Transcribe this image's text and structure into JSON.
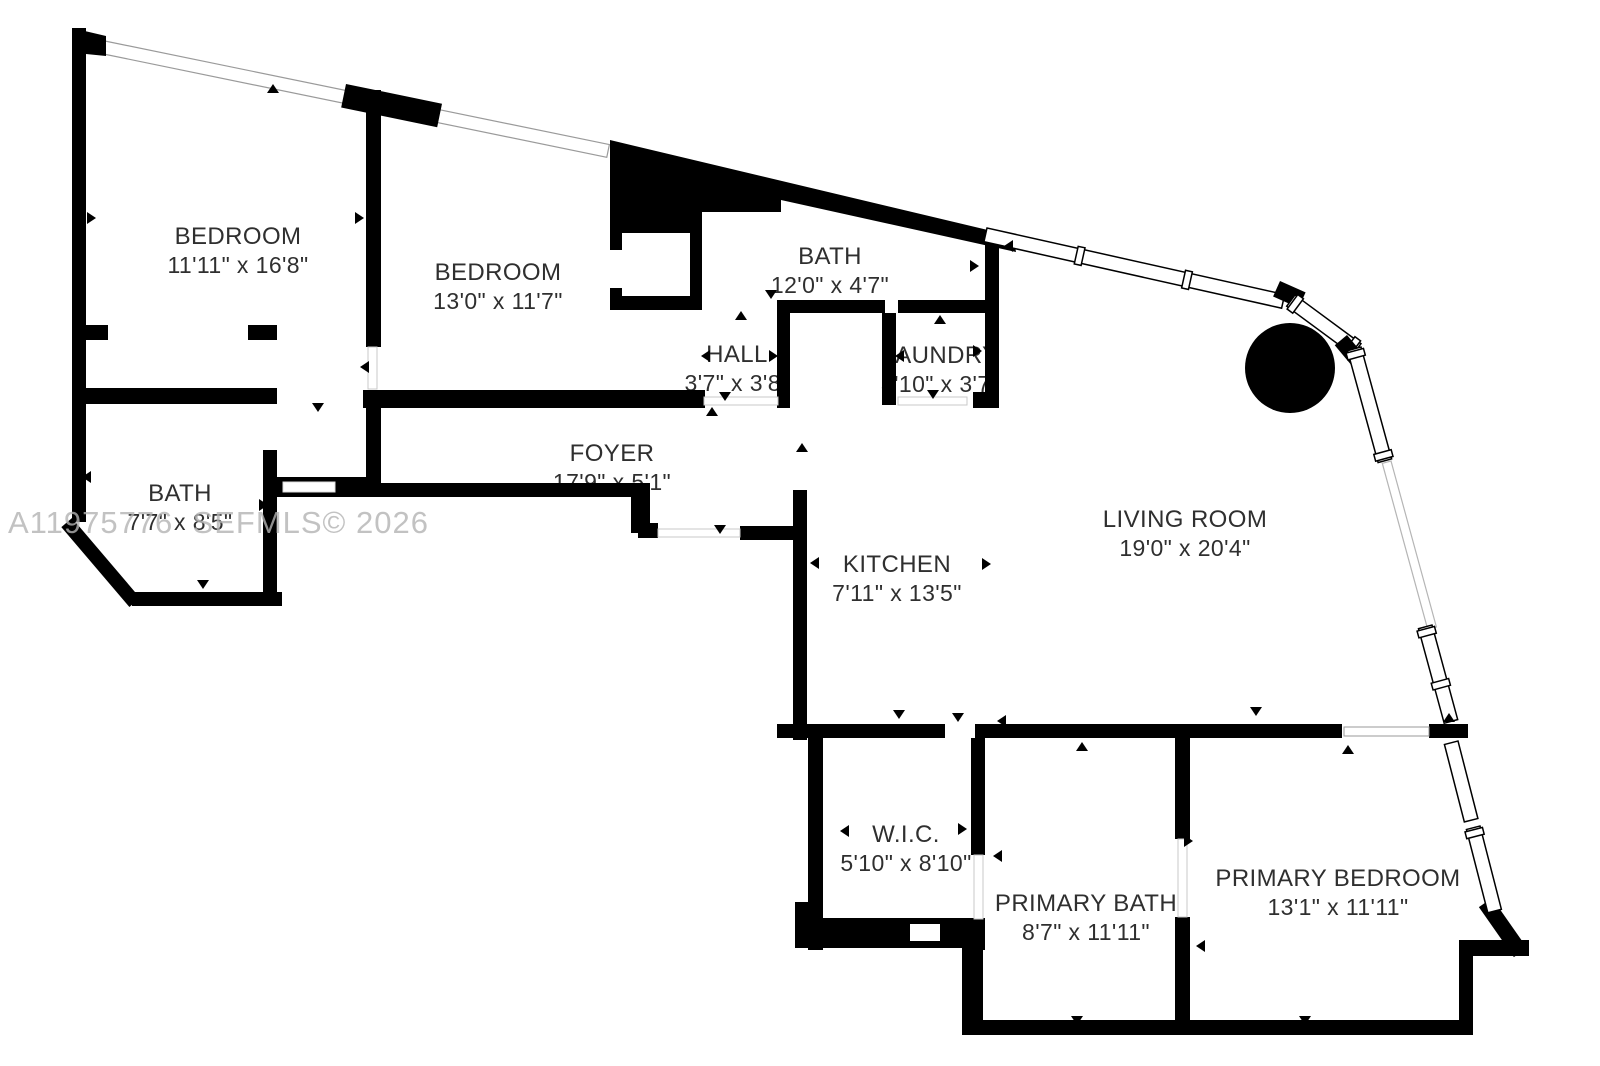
{
  "floor_plan": {
    "watermark": "A11975776  SEFMLS© 2026",
    "colors": {
      "wall": "#000000",
      "background": "#ffffff",
      "label_text": "#2f2f2f",
      "watermark_text": "#b3b3b3",
      "window_outline": "#9a9a9a"
    },
    "symbols": {
      "structural_column": "filled-circle",
      "door_swing": "small-triangle",
      "window": "double-line-band"
    },
    "rooms": [
      {
        "id": "bedroom-1",
        "name": "BEDROOM",
        "dims": "11'11\" x 16'8\""
      },
      {
        "id": "bedroom-2",
        "name": "BEDROOM",
        "dims": "13'0\" x 11'7\""
      },
      {
        "id": "bath-top",
        "name": "BATH",
        "dims": "12'0\" x 4'7\""
      },
      {
        "id": "hall",
        "name": "HALL",
        "dims": "3'7\" x 3'8\""
      },
      {
        "id": "laundry",
        "name": "LAUNDRY",
        "dims": "3'10\" x 3'7\""
      },
      {
        "id": "bath-left",
        "name": "BATH",
        "dims": "7'7\" x 8'5\""
      },
      {
        "id": "foyer",
        "name": "FOYER",
        "dims": "17'9\" x 5'1\""
      },
      {
        "id": "kitchen",
        "name": "KITCHEN",
        "dims": "7'11\" x 13'5\""
      },
      {
        "id": "living-room",
        "name": "LIVING ROOM",
        "dims": "19'0\" x 20'4\""
      },
      {
        "id": "wic",
        "name": "W.I.C.",
        "dims": "5'10\" x 8'10\""
      },
      {
        "id": "primary-bath",
        "name": "PRIMARY BATH",
        "dims": "8'7\" x 11'11\""
      },
      {
        "id": "primary-bedroom",
        "name": "PRIMARY BEDROOM",
        "dims": "13'1\" x 11'11\""
      }
    ]
  }
}
